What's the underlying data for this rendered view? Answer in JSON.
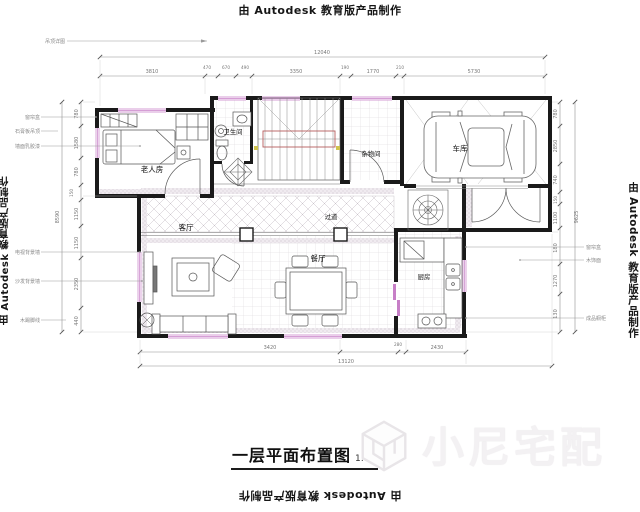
{
  "watermark": {
    "autodesk": "由 Autodesk 教育版产品制作",
    "brand": "小尼宅配"
  },
  "title": {
    "text": "一层平面布置图",
    "scale": "1:80"
  },
  "rooms": {
    "elder": "老人房",
    "bath": "卫生间",
    "storage": "杂物间",
    "garage": "车库",
    "hallway": "过道",
    "living": "客厅",
    "dining": "餐厅",
    "kitchen": "厨房"
  },
  "dims": {
    "top_total": "12040",
    "top": [
      "3810",
      "470",
      "670",
      "490",
      "3350",
      "190",
      "1770",
      "210",
      "5730"
    ],
    "bottom": [
      "3420",
      "280",
      "2430"
    ],
    "bottom_total": "13120",
    "left": [
      "780",
      "1580",
      "780",
      "150",
      "1150",
      "1150",
      "2350",
      "440"
    ],
    "left_total": "8590",
    "right": [
      "780",
      "2850",
      "740",
      "150",
      "1100",
      "180",
      "1270",
      "130"
    ],
    "right_total": "9625"
  },
  "notes": {
    "top_left": "吊顶详图",
    "left": [
      "窗帘盒",
      "石膏板吊顶",
      "墙面乳胶漆",
      "电视背景墙",
      "沙发背景墙",
      "木踢脚线"
    ],
    "right": [
      "窗帘盒",
      "木饰面",
      "成品橱柜"
    ]
  }
}
